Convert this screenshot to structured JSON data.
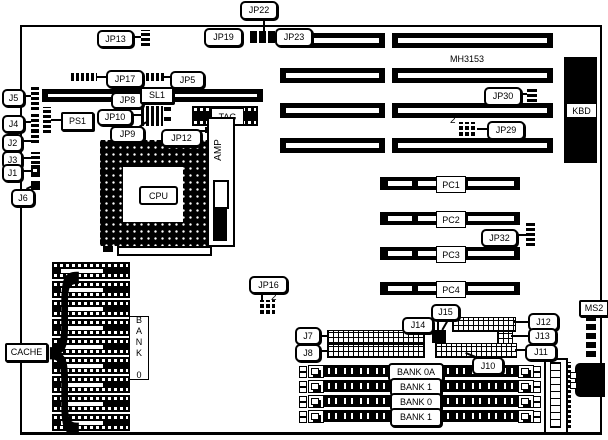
{
  "diagram": {
    "model": "MH3153",
    "pin2_marker": "2",
    "colors": {
      "ink": "#000000",
      "background": "#ffffff"
    },
    "labels": {
      "jp22": "JP22",
      "jp19": "JP19",
      "jp23": "JP23",
      "jp13": "JP13",
      "jp17": "JP17",
      "jp5": "JP5",
      "j5": "J5",
      "jp8": "JP8",
      "sl1": "SL1",
      "ps1": "PS1",
      "jp10": "JP10",
      "j4": "J4",
      "jp9": "JP9",
      "jp12": "JP12",
      "j2": "J2",
      "j3": "J3",
      "j1": "J1",
      "j6": "J6",
      "cpu": "CPU",
      "amp": "AMP",
      "tag": "TAG",
      "kbd": "KBD",
      "jp30": "JP30",
      "jp29": "JP29",
      "jp32": "JP32",
      "jp16": "JP16",
      "cache": "CACHE",
      "j7": "J7",
      "j8": "J8",
      "j14": "J14",
      "j15": "J15",
      "j12": "J12",
      "j13": "J13",
      "j11": "J11",
      "j10": "J10",
      "ms2": "MS2"
    },
    "pci_slots": [
      "PC1",
      "PC2",
      "PC3",
      "PC4"
    ],
    "simm_banks": [
      "BANK 0A",
      "BANK 1",
      "BANK 0",
      "BANK 1"
    ],
    "cache_bank_vertical": "BANK 0"
  }
}
